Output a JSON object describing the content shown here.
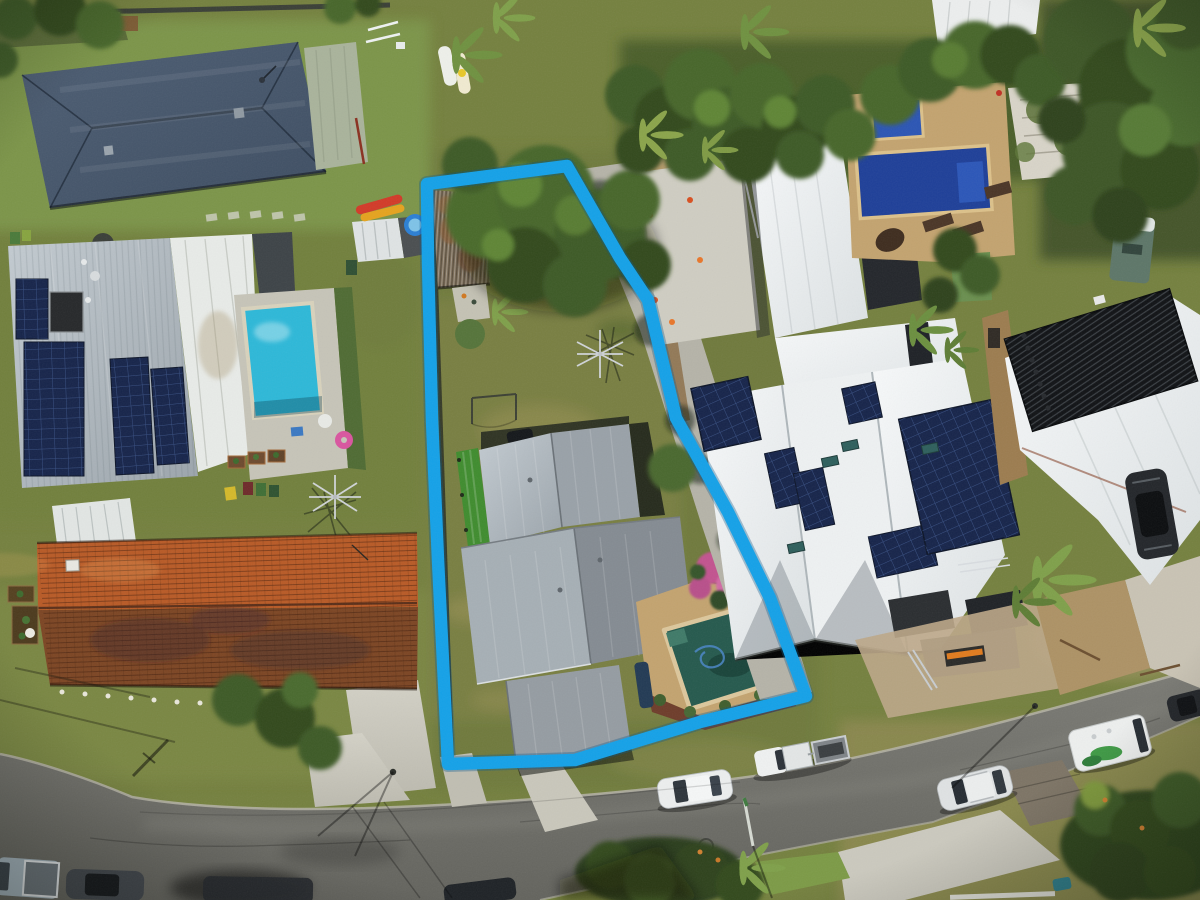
{
  "scene": {
    "type": "aerial-drone-photograph",
    "subject": "residential lot highlighted with a blue boundary outline for a real-estate listing",
    "boundary_color": "#14a1e8",
    "boundary_underlay": "rgba(8,90,140,0.35)",
    "palette": {
      "grass": "#75813f",
      "grass_bright": "#7d974a",
      "grass_dark": "#5d6c31",
      "grass_dry": "#9d9459",
      "road": "#73736d",
      "curb": "#b5b3a6",
      "concrete": "#c9c7bb",
      "pavers_brown": "#7d7465",
      "paving_tan": "#c3a36f",
      "dirt": "#b49a6c",
      "apron": "#bda788",
      "roof_slate": "#46566b",
      "roof_sage": "#a9b39b",
      "roof_gray": "#b4bcc3",
      "roof_white": "#eef1f2",
      "roof_white_dim": "#e2e6e5",
      "roof_house_gray": "#99a1a8",
      "roof_orange": "#b85a26",
      "roof_orange_dark": "#7c4523",
      "shed_rust": "#7a6b56",
      "solar_navy": "#16244a",
      "tubes_black": "#101215",
      "pool_cyan": "#2db8d8",
      "pool_blue": "#1e3f98",
      "pool_teal": "#25594d",
      "tree_dark": "#33491f",
      "tree": "#486a2c",
      "tree_light": "#5f8536",
      "palm": "#7fa04a",
      "turf": "#3f8c2e",
      "flower_pink": "#c2538f",
      "mulch": "#6e3c2a",
      "timber": "#9c7c4f",
      "vehicle_white": "#eceeee",
      "vehicle_silver": "#dfe2e3",
      "vehicle_dark": "#23262a",
      "vehicle_blue": "#a3b3bd",
      "vehicle_red": "#8e2220",
      "kayak_red": "#d23a28",
      "kayak_yellow": "#e5a31e",
      "float_pink": "#d9559f",
      "caravan_green": "#5d7668",
      "graphic_green": "#3f9a45",
      "bin_yellow": "#d4b92a"
    },
    "objects": [
      {
        "name": "property-boundary",
        "desc": "thick blue polygon outlining long narrow lot"
      },
      {
        "name": "subject-house",
        "desc": "gray metal multi-section roof house"
      },
      {
        "name": "subject-pool",
        "desc": "dark teal pool with stone coping and blue hose"
      },
      {
        "name": "subject-shed",
        "desc": "weathered rusty corrugated shed at rear"
      },
      {
        "name": "subject-trees",
        "desc": "large green canopy at rear of lot"
      },
      {
        "name": "clothesline",
        "desc": "rotary clothesline on lawn"
      },
      {
        "name": "slate-roof-house",
        "desc": "dark blue-gray hip roof house top left"
      },
      {
        "name": "solar-roof-house",
        "desc": "light gray roof with navy solar columns and cyan pool"
      },
      {
        "name": "terracotta-house",
        "desc": "long orange tiled roof house lower left"
      },
      {
        "name": "white-modern-house",
        "desc": "white roofed house with many solar arrays right"
      },
      {
        "name": "royal-pool",
        "desc": "deep blue pool with spa and tan paving top right"
      },
      {
        "name": "solar-tube-roof",
        "desc": "white roof with black solar pool-heating tubes far right"
      },
      {
        "name": "road",
        "desc": "diagonal suburban street with parked cars"
      },
      {
        "name": "vehicles",
        "desc": "white sedan, ute with trailer, silver SUV, campervan, dark cars"
      },
      {
        "name": "kayaks",
        "desc": "red and yellow kayaks beside shed"
      },
      {
        "name": "paddleboards",
        "desc": "two paddleboards on lawn"
      }
    ]
  }
}
